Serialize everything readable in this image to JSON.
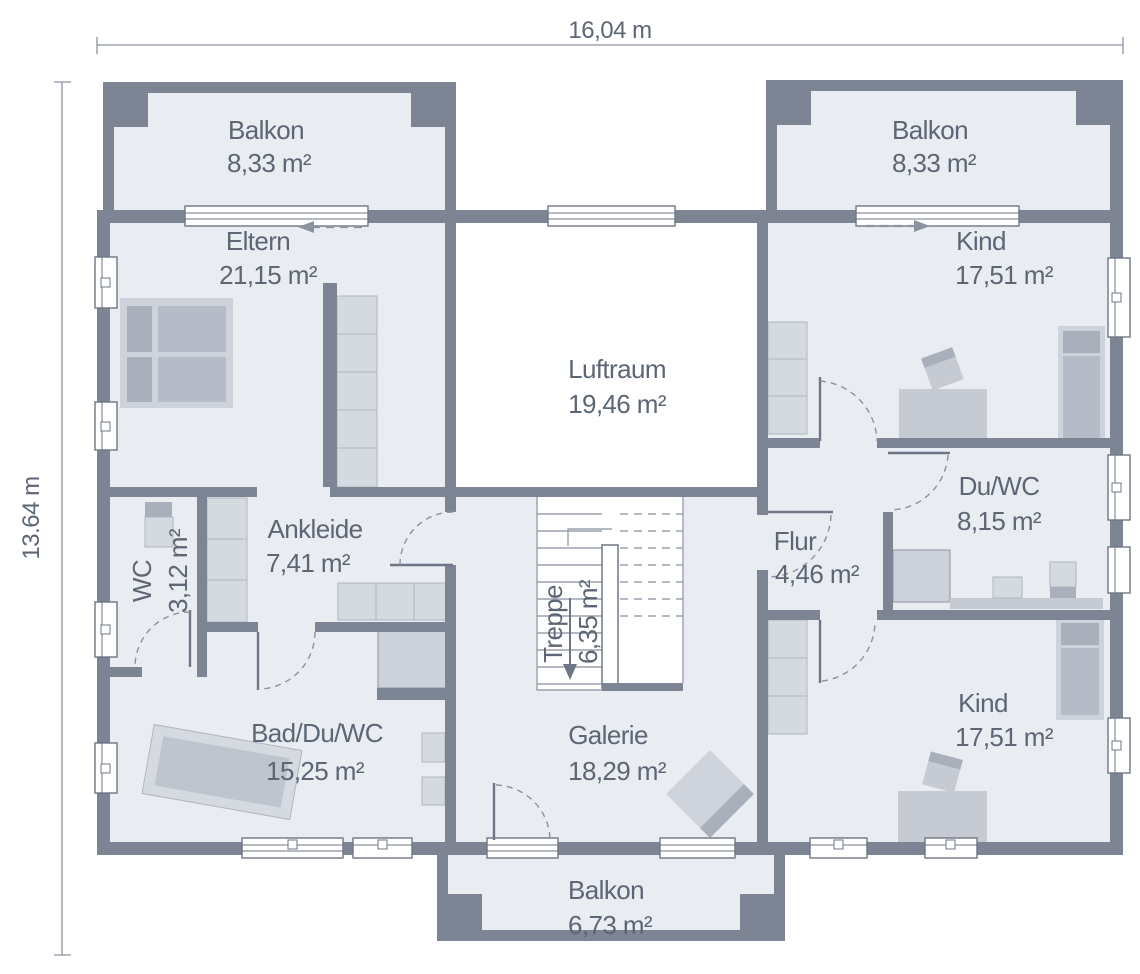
{
  "plan": {
    "dimensions": {
      "width_label": "16,04 m",
      "height_label": "13.64 m"
    },
    "rooms": [
      {
        "name": "Balkon",
        "area": "8,33 m²"
      },
      {
        "name": "Balkon",
        "area": "8,33 m²"
      },
      {
        "name": "Eltern",
        "area": "21,15 m²"
      },
      {
        "name": "Kind",
        "area": "17,51 m²"
      },
      {
        "name": "Luftraum",
        "area": "19,46 m²"
      },
      {
        "name": "Ankleide",
        "area": "7,41 m²"
      },
      {
        "name": "WC",
        "area": "3,12 m²"
      },
      {
        "name": "Flur",
        "area": "4,46 m²"
      },
      {
        "name": "Du/WC",
        "area": "8,15 m²"
      },
      {
        "name": "Treppe",
        "area": "6,35 m²"
      },
      {
        "name": "Bad/Du/WC",
        "area": "15,25 m²"
      },
      {
        "name": "Galerie",
        "area": "18,29 m²"
      },
      {
        "name": "Kind",
        "area": "17,51 m²"
      },
      {
        "name": "Balkon",
        "area": "6,73 m²"
      }
    ],
    "colors": {
      "wall": "#7d8594",
      "floor": "#e9ecf1",
      "void": "#ffffff",
      "furniture_light": "#ced2da",
      "furniture_mid": "#b6bcc7",
      "furniture_dark": "#a9b0bc",
      "text": "#5d6675",
      "line": "#8b92a0"
    }
  }
}
